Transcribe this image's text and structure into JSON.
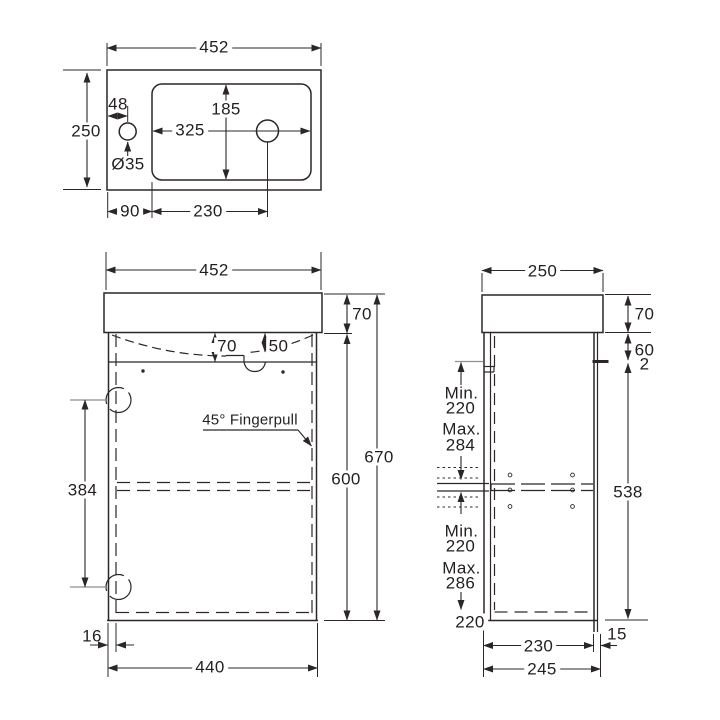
{
  "drawing": {
    "top_view": {
      "width": "452",
      "depth": "250",
      "tap_hole_offset": "48",
      "basin_length": "325",
      "basin_width": "185",
      "tap_hole_diameter": "Ø35",
      "tap_hole_from_left": "90",
      "waste_offset": "230"
    },
    "front_view": {
      "width": "452",
      "basin_height": "70",
      "bowl_depth_left": "70",
      "bowl_depth_right": "50",
      "hinge_spacing": "384",
      "fingerpull_note": "45° Fingerpull",
      "cabinet_height": "600",
      "overall_height": "670",
      "door_thickness": "16",
      "door_width": "440"
    },
    "side_view": {
      "depth": "250",
      "basin_height": "70",
      "top_rail": "60",
      "gap": "2",
      "upper_shelf_range": {
        "min_label": "Min.",
        "min_value": "220",
        "max_label": "Max.",
        "max_value": "284"
      },
      "lower_shelf_range": {
        "min_label": "Min.",
        "min_value": "220",
        "max_label": "Max.",
        "max_value": "286"
      },
      "bottom_value": "220",
      "carcass_height": "538",
      "base_depth": "230",
      "back_inset": "15",
      "overall_depth": "245"
    }
  }
}
